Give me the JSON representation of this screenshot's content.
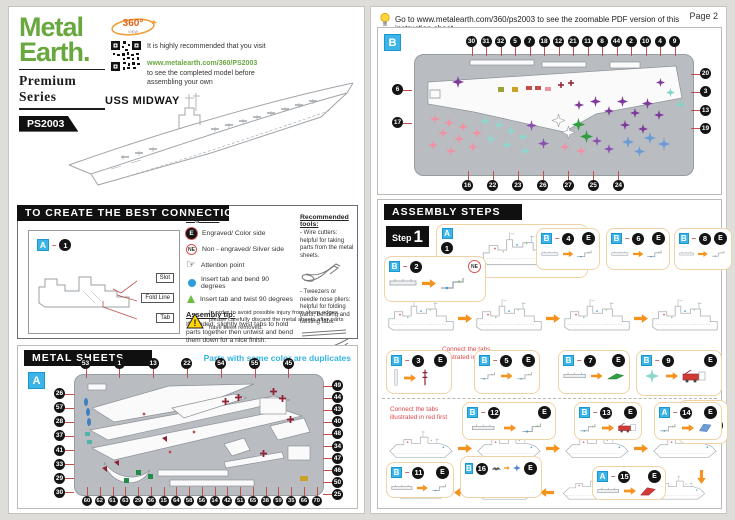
{
  "dash": "–",
  "colors": {
    "brand_green": "#69a83f",
    "accent_cyan": "#35b4e4",
    "arrow_orange": "#f6921e",
    "leader_red": "#c0504d",
    "note_red": "#e0474b"
  },
  "brand": {
    "name_line1": "Metal",
    "name_line2": "Earth.",
    "series": "Premium Series",
    "sku": "PS2003",
    "badge_360": "360°",
    "badge_360_sub": "VIEW"
  },
  "intro": {
    "rec_line1": "It is highly recommended that you visit",
    "rec_url": "www.metalearth.com/360/PS2003",
    "rec_line2": "to see the completed model before assembling your own",
    "model_name": "USS MIDWAY"
  },
  "connections": {
    "title": "TO CREATE THE BEST CONNECTIONS",
    "example": {
      "sheet_letter": "A",
      "part_number": "1",
      "label_slot": "Slot",
      "label_fold": "Fold Line",
      "label_tab": "Tab"
    },
    "legends_title": "Legends:",
    "legend_engraved_symbol": "E",
    "legend_engraved": "Engraved/ Color side",
    "legend_non_engraved_symbol": "NE",
    "legend_non_engraved": "Non - engraved/ Silver side",
    "attention_glyph": "☞",
    "legend_attention": "Attention point",
    "legend_bend": "Insert tab and bend 90 degrees",
    "legend_twist": "Insert tab and twist 90 degrees",
    "tip_title": "Assembly tip:",
    "tip_text": "If needed, slightly twist tabs to hold parts together then untwist and bend them down for a nice finish.",
    "tools_title": "Recommended tools:",
    "tool1": "- Wire cutters: helpful for taking parts from the metal sheets.",
    "tool2": "- Tweezers or needle nose pliers: helpful for folding parts, bending and twisting tabs.",
    "warning": "In order to avoid possible injury from sharp edges, please carefully discard the metal sheets after parts have been removed."
  },
  "metal_sheets": {
    "title": "METAL SHEETS",
    "duplicates_note": "Parts with same color are duplicates",
    "sheet_a": {
      "letter": "A",
      "numbers_top": [
        "53",
        "1",
        "13",
        "22",
        "54",
        "55",
        "45"
      ],
      "numbers_left": [
        "26",
        "57",
        "28",
        "37",
        "41",
        "33",
        "29",
        "30"
      ],
      "numbers_right": [
        "49",
        "44",
        "43",
        "40",
        "48",
        "34",
        "47",
        "46",
        "50",
        "25"
      ],
      "numbers_bottom": [
        "60",
        "62",
        "61",
        "63",
        "29",
        "36",
        "15",
        "64",
        "58",
        "56",
        "14",
        "42",
        "51",
        "65",
        "38",
        "59",
        "35",
        "66",
        "70"
      ]
    }
  },
  "page2": {
    "header_note": "Go to www.metalearth.com/360/ps2003 to see the zoomable PDF version of this instruction sheet",
    "page_label": "Page 2",
    "sheet_b": {
      "letter": "B",
      "numbers_top": [
        "30",
        "31",
        "32",
        "5",
        "7",
        "18",
        "12",
        "21",
        "11",
        "8",
        "44",
        "2",
        "10",
        "4",
        "9"
      ],
      "numbers_left": [
        "6",
        "17"
      ],
      "numbers_right": [
        "20",
        "3",
        "13",
        "19"
      ],
      "numbers_bottom": [
        "16",
        "22",
        "23",
        "26",
        "27",
        "25",
        "24"
      ]
    },
    "assembly": {
      "title": "ASSEMBLY STEPS",
      "step_word": "Step",
      "step_number": "1",
      "red_note_1": "Connect the tabs illustrated in red first",
      "red_note_2": "Connect the tabs illustrated in red first",
      "engraved_symbol": "E",
      "non_engraved_symbol": "NE",
      "callouts": [
        {
          "sheet": "A",
          "part": "1",
          "marker": ""
        },
        {
          "sheet": "B",
          "part": "2",
          "marker": "NE"
        },
        {
          "sheet": "B",
          "part": "4",
          "marker": "E"
        },
        {
          "sheet": "B",
          "part": "6",
          "marker": "E"
        },
        {
          "sheet": "B",
          "part": "8",
          "marker": "E"
        },
        {
          "sheet": "B",
          "part": "3",
          "marker": "E"
        },
        {
          "sheet": "B",
          "part": "5",
          "marker": "E"
        },
        {
          "sheet": "B",
          "part": "7",
          "marker": "E"
        },
        {
          "sheet": "B",
          "part": "9",
          "marker": "E"
        },
        {
          "sheet": "B",
          "part": "10",
          "marker": "E"
        },
        {
          "sheet": "B",
          "part": "12",
          "marker": "E"
        },
        {
          "sheet": "B",
          "part": "13",
          "marker": "E"
        },
        {
          "sheet": "A",
          "part": "14",
          "marker": "E"
        },
        {
          "sheet": "B",
          "part": "11",
          "marker": "E"
        },
        {
          "sheet": "B",
          "part": "16",
          "marker": "E"
        },
        {
          "sheet": "A",
          "part": "15",
          "marker": "E"
        }
      ]
    }
  }
}
